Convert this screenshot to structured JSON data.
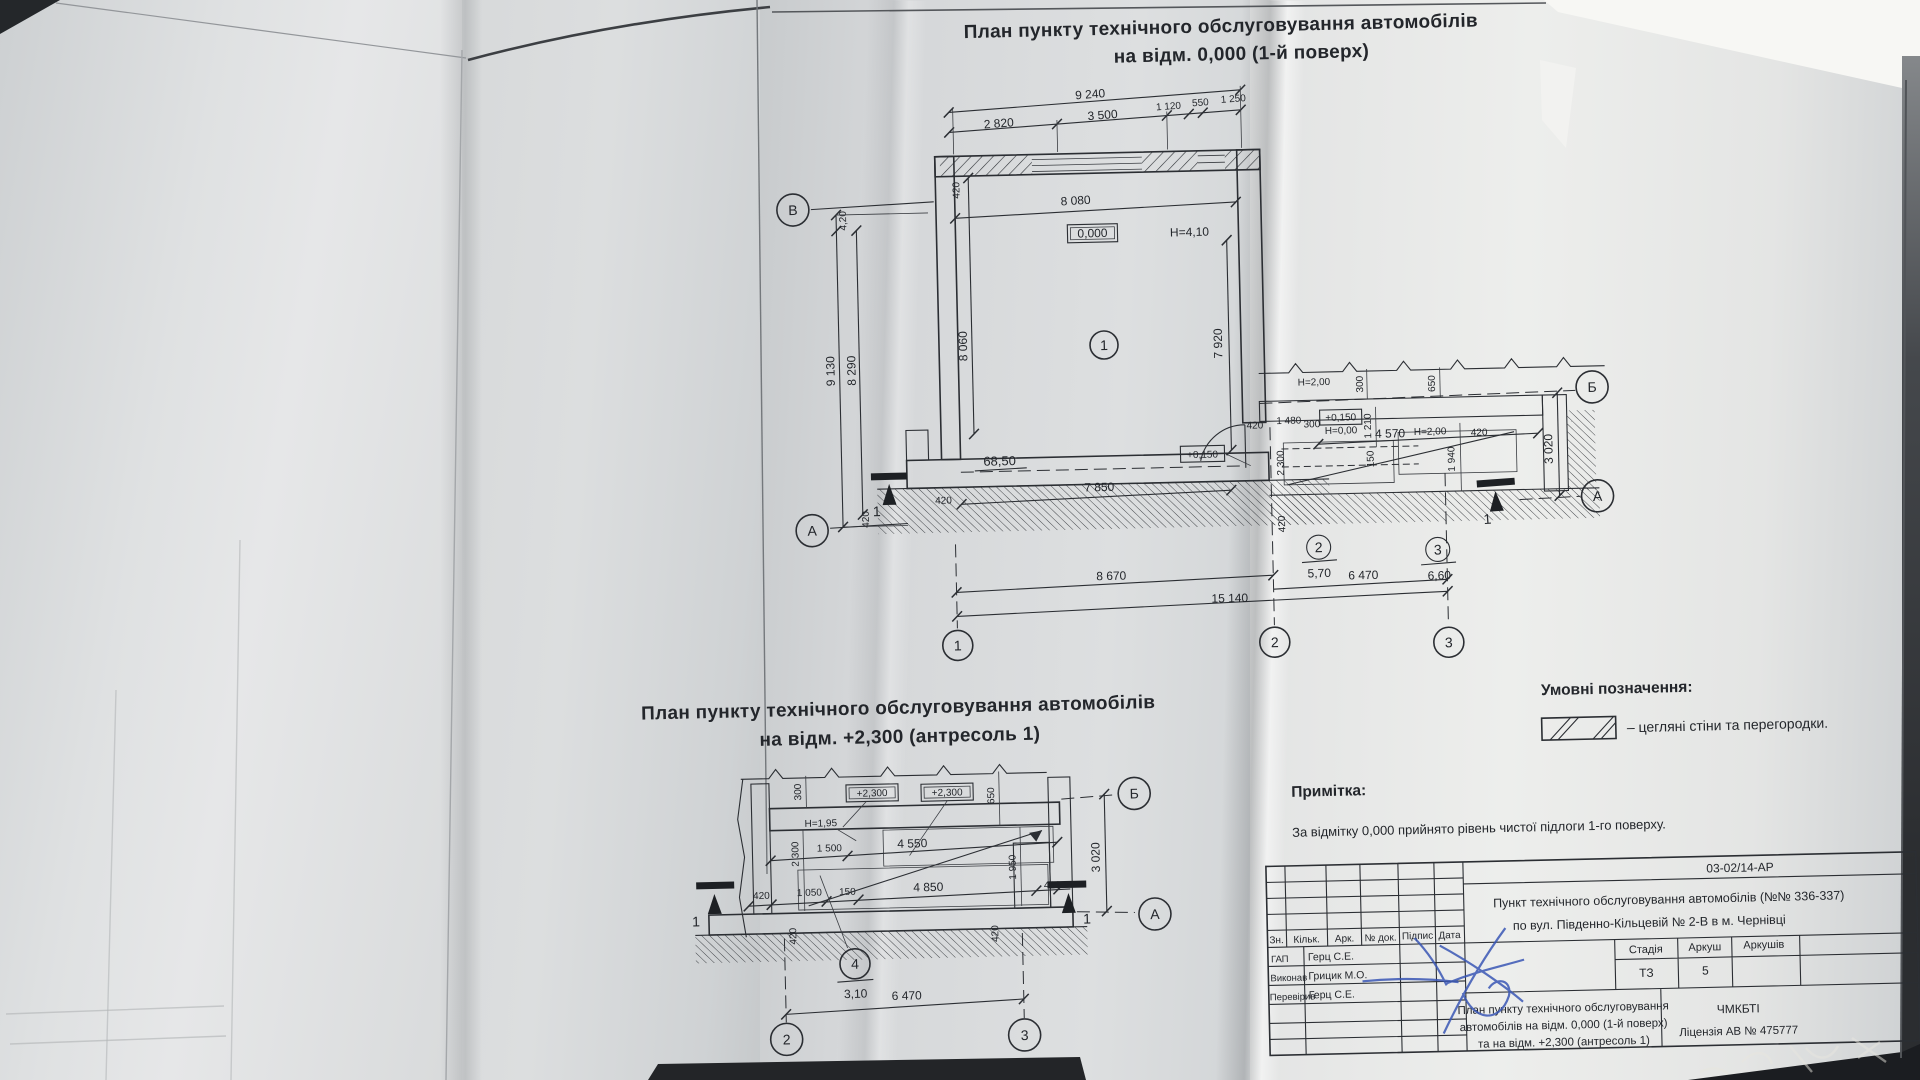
{
  "plan1": {
    "title_line1": "План пункту технічного обслуговування автомобілів",
    "title_line2": "на відм. 0,000 (1-й поверх)"
  },
  "plan2": {
    "title_line1": "План пункту технічного обслуговування автомобілів",
    "title_line2": "на відм. +2,300 (антресоль 1)"
  },
  "labels": {
    "n9240": "9 240",
    "n2820": "2 820",
    "n3500": "3 500",
    "n1120": "1 120",
    "n550": "550",
    "n1250": "1 250",
    "n8080": "8 080",
    "n8060": "8 060",
    "n8290": "8 290",
    "n9130": "9 130",
    "n7920": "7 920",
    "n7850": "7 850",
    "n8670": "8 670",
    "n15140": "15 140",
    "n6470": "6 470",
    "n420": "420",
    "c420": "4,20",
    "lvl0": "0,000",
    "lvl015": "+0,150",
    "lvl23": "+2,300",
    "h410": "Н=4,10",
    "h200": "Н=2,00",
    "h000": "Н=0,00",
    "h195": "Н=1,95",
    "n2300": "2 300",
    "n1480": "1 480",
    "n300": "300",
    "n650": "650",
    "n1210": "1 210",
    "n4570": "4 570",
    "n1940": "1 940",
    "n150": "150",
    "n3020": "3 020",
    "n1500": "1 500",
    "n4550": "4 550",
    "n1950": "1 950",
    "n1050": "1 050",
    "n4850": "4 850",
    "sec1": "1"
  },
  "grid": {
    "v": "В",
    "a": "А",
    "b": "Б",
    "n1": "1",
    "n2": "2",
    "n3": "3",
    "n4": "4"
  },
  "rooms": {
    "r1": "1",
    "r1_area": "68,50",
    "r2": "2",
    "r2_area": "5,70",
    "r3": "3",
    "r3_area": "6,60",
    "r4": "4",
    "r4_area": "3,10"
  },
  "legend": {
    "title": "Умовні позначення:",
    "item1": "–  цегляні стіни та перегородки."
  },
  "note": {
    "title": "Примітка:",
    "text": "За відмітку 0,000 прийнято рівень чистої підлоги 1-го поверху."
  },
  "stamp": {
    "doc_number": "03-02/14-АР",
    "project_line1": "Пункт технічного обслуговування автомобілів (№№ 336-337)",
    "project_line2": "по вул. Південно-Кільцевій № 2-В в м. Чернівці",
    "col_zn": "Зн.",
    "col_kilk": "Кільк.",
    "col_ark": "Арк.",
    "col_doc": "№ док.",
    "col_sign": "Підпис",
    "col_date": "Дата",
    "row1_role": "ГАП",
    "row1_name": "Герц С.Е.",
    "row2_role": "Виконав",
    "row2_name": "Грицик М.О.",
    "row3_role": "Перевірив",
    "row3_name": "Герц С.Е.",
    "stage_label": "Стадія",
    "sheet_label": "Аркуш",
    "sheets_label": "Аркушів",
    "stage_value": "ТЗ",
    "sheet_value": "5",
    "title_line1": "План пункту технічного обслуговування",
    "title_line2": "автомобілів на відм. 0,000 (1-й поверх)",
    "title_line3": "та на відм. +2,300 (антресоль 1)",
    "org_line1": "ЧМКБТІ",
    "org_line2": "Ліцензія АВ № 475777"
  }
}
